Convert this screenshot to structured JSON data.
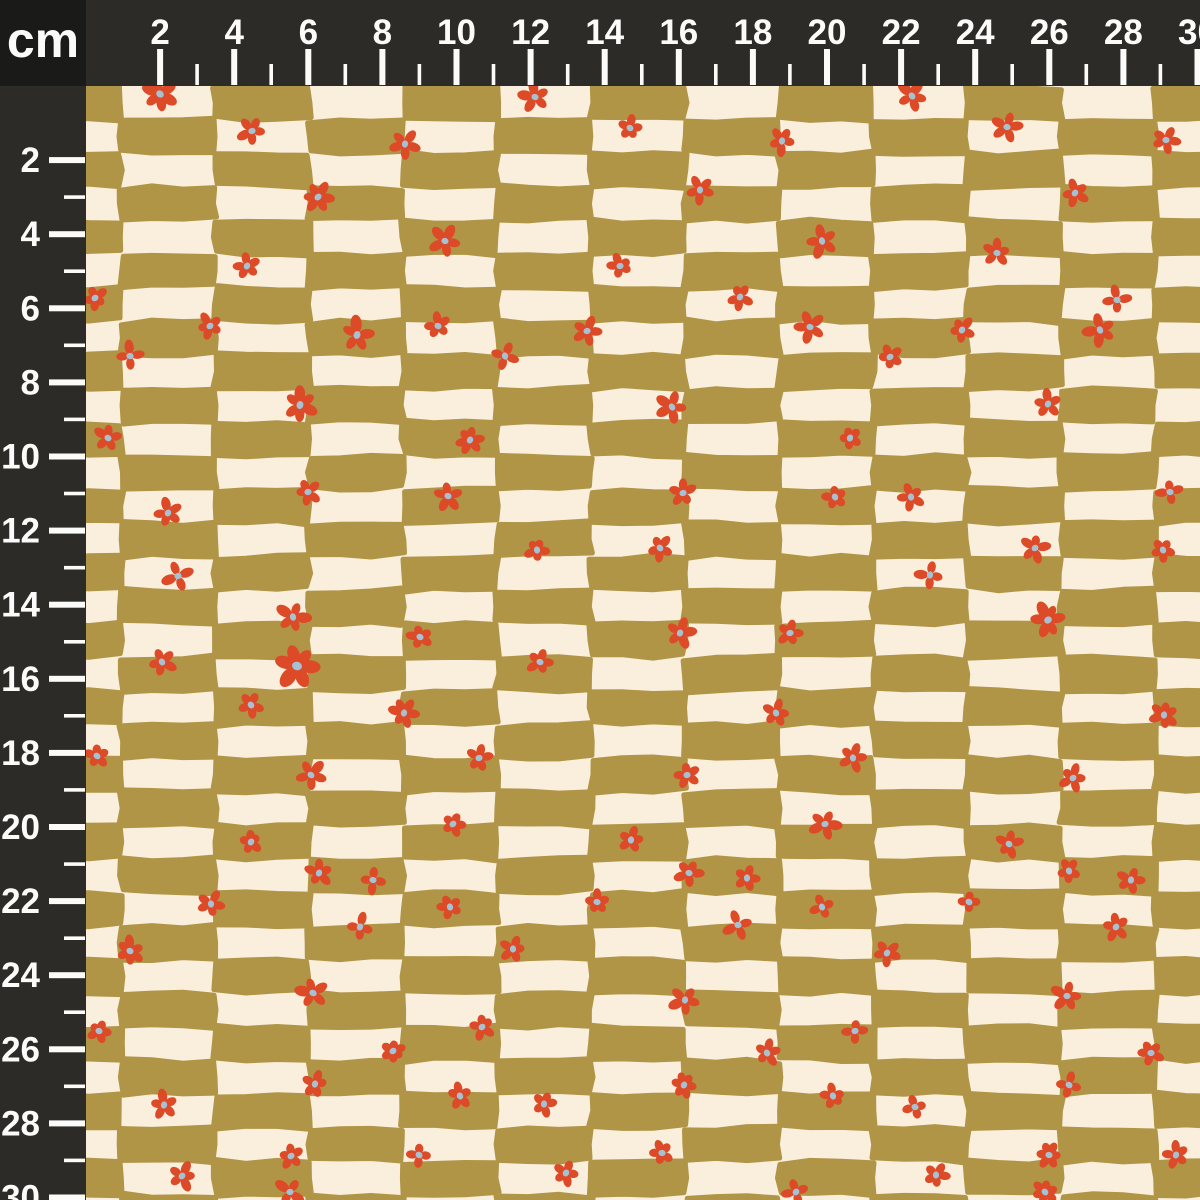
{
  "meta": {
    "description": "Fabric swatch scale preview with centimeter rulers",
    "canvas": {
      "width": 1200,
      "height": 1200
    }
  },
  "ruler": {
    "unit_label": "cm",
    "px_per_cm": 37.05,
    "origin_px": 86,
    "strip_thickness_px": 86,
    "first_tick_cm": 2,
    "last_tick_cm": 30,
    "label_step_cm": 2,
    "top_labels": [
      "2",
      "4",
      "6",
      "8",
      "10",
      "12",
      "14",
      "16",
      "18",
      "20",
      "22",
      "24",
      "26",
      "28",
      "30"
    ],
    "left_labels": [
      "2",
      "4",
      "6",
      "8",
      "10",
      "12",
      "14",
      "16",
      "18",
      "20",
      "22",
      "24",
      "26",
      "28",
      "30"
    ],
    "colors": {
      "strip": "#2d2b28",
      "unit_box": "#1a1a19",
      "tick": "#fbfbfa",
      "label": "#fbfbfa"
    }
  },
  "fabric": {
    "colors": {
      "olive": "#b09547",
      "cream": "#f9efdc",
      "flower_red": "#dc4a28",
      "flower_center_blue": "#a5c1d4"
    },
    "checker": {
      "cell_w": 94,
      "cell_h": 33.6,
      "x0": 27,
      "y0": 86,
      "cols": 13,
      "rows": 34,
      "olive_parity": "even"
    },
    "flowers": [
      [
        160,
        94,
        16
      ],
      [
        535,
        97,
        14
      ],
      [
        912,
        96,
        15
      ],
      [
        252,
        131,
        13
      ],
      [
        405,
        144,
        13
      ],
      [
        630,
        128,
        11
      ],
      [
        782,
        141,
        13
      ],
      [
        1007,
        127,
        13
      ],
      [
        1166,
        140,
        12
      ],
      [
        318,
        197,
        15,
        6
      ],
      [
        700,
        190,
        13
      ],
      [
        1075,
        193,
        12
      ],
      [
        445,
        241,
        14
      ],
      [
        822,
        241,
        15
      ],
      [
        997,
        253,
        12
      ],
      [
        247,
        266,
        12
      ],
      [
        620,
        266,
        11
      ],
      [
        95,
        298,
        11
      ],
      [
        740,
        297,
        12
      ],
      [
        1117,
        300,
        13
      ],
      [
        210,
        326,
        12
      ],
      [
        357,
        335,
        16
      ],
      [
        438,
        326,
        12
      ],
      [
        587,
        331,
        13
      ],
      [
        810,
        327,
        14
      ],
      [
        962,
        330,
        12
      ],
      [
        1100,
        330,
        15
      ],
      [
        130,
        356,
        13
      ],
      [
        505,
        356,
        12
      ],
      [
        890,
        357,
        11
      ],
      [
        300,
        405,
        16
      ],
      [
        672,
        407,
        15
      ],
      [
        1048,
        404,
        14
      ],
      [
        108,
        438,
        13
      ],
      [
        470,
        440,
        12
      ],
      [
        850,
        438,
        10
      ],
      [
        308,
        492,
        12
      ],
      [
        448,
        496,
        13
      ],
      [
        683,
        493,
        12
      ],
      [
        835,
        497,
        11
      ],
      [
        911,
        497,
        12
      ],
      [
        1170,
        492,
        12
      ],
      [
        168,
        513,
        13
      ],
      [
        537,
        550,
        11
      ],
      [
        660,
        548,
        12
      ],
      [
        1035,
        548,
        13
      ],
      [
        1163,
        550,
        11
      ],
      [
        178,
        576,
        14
      ],
      [
        930,
        575,
        13
      ],
      [
        293,
        617,
        15
      ],
      [
        1048,
        620,
        16
      ],
      [
        420,
        637,
        12
      ],
      [
        680,
        633,
        14
      ],
      [
        790,
        633,
        12
      ],
      [
        162,
        662,
        13
      ],
      [
        540,
        662,
        12
      ],
      [
        297,
        666,
        20,
        6
      ],
      [
        251,
        705,
        12
      ],
      [
        404,
        713,
        13
      ],
      [
        776,
        713,
        13
      ],
      [
        1164,
        715,
        13
      ],
      [
        97,
        756,
        11
      ],
      [
        311,
        775,
        14
      ],
      [
        479,
        758,
        12
      ],
      [
        687,
        775,
        12
      ],
      [
        853,
        758,
        13
      ],
      [
        1073,
        778,
        12
      ],
      [
        453,
        824,
        11
      ],
      [
        825,
        824,
        14
      ],
      [
        631,
        840,
        12
      ],
      [
        251,
        842,
        10
      ],
      [
        1009,
        844,
        12
      ],
      [
        319,
        873,
        12
      ],
      [
        373,
        880,
        12
      ],
      [
        1069,
        871,
        12
      ],
      [
        689,
        873,
        13
      ],
      [
        747,
        878,
        11
      ],
      [
        1131,
        880,
        12
      ],
      [
        450,
        907,
        11
      ],
      [
        211,
        904,
        12
      ],
      [
        822,
        907,
        11
      ],
      [
        969,
        902,
        10
      ],
      [
        597,
        902,
        11
      ],
      [
        513,
        949,
        12
      ],
      [
        360,
        927,
        13,
        4
      ],
      [
        738,
        925,
        14,
        4
      ],
      [
        1116,
        927,
        13
      ],
      [
        887,
        953,
        12
      ],
      [
        130,
        951,
        13
      ],
      [
        313,
        993,
        15
      ],
      [
        1067,
        996,
        14
      ],
      [
        685,
        1000,
        14
      ],
      [
        99,
        1031,
        10
      ],
      [
        482,
        1027,
        12
      ],
      [
        855,
        1031,
        11
      ],
      [
        393,
        1051,
        11
      ],
      [
        767,
        1053,
        12
      ],
      [
        1151,
        1053,
        12
      ],
      [
        315,
        1084,
        12
      ],
      [
        164,
        1105,
        13
      ],
      [
        460,
        1096,
        12
      ],
      [
        544,
        1104,
        12
      ],
      [
        684,
        1085,
        11
      ],
      [
        1069,
        1085,
        12
      ],
      [
        833,
        1096,
        11
      ],
      [
        915,
        1107,
        11
      ],
      [
        291,
        1156,
        11
      ],
      [
        419,
        1155,
        11
      ],
      [
        182,
        1176,
        13
      ],
      [
        566,
        1173,
        12
      ],
      [
        1049,
        1155,
        12
      ],
      [
        1176,
        1155,
        12
      ],
      [
        662,
        1153,
        11
      ],
      [
        936,
        1175,
        12
      ],
      [
        290,
        1192,
        14
      ],
      [
        796,
        1192,
        13
      ],
      [
        1045,
        1192,
        12
      ]
    ]
  }
}
